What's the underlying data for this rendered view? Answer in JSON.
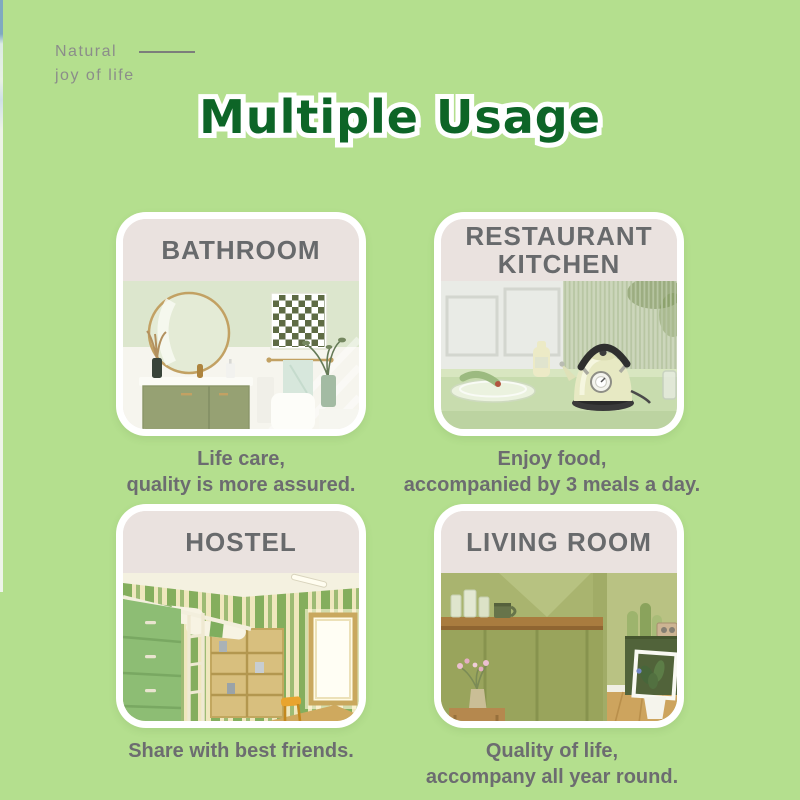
{
  "brand": {
    "line1": "Natural",
    "line2": "joy of life"
  },
  "title": "Multiple Usage",
  "cards": [
    {
      "id": "bathroom",
      "title": "BATHROOM",
      "caption": [
        "Life care,",
        "quality is more assured."
      ]
    },
    {
      "id": "restaurant-kitchen",
      "title": "RESTAURANT KITCHEN",
      "caption": [
        "Enjoy food,",
        "accompanied by 3 meals a day."
      ]
    },
    {
      "id": "hostel",
      "title": "HOSTEL",
      "caption": [
        "Share with best friends."
      ]
    },
    {
      "id": "living-room",
      "title": "LIVING ROOM",
      "caption": [
        "Quality of life,",
        "accompany all year round."
      ]
    }
  ],
  "colors": {
    "background": "#b4df8e",
    "title_green": "#0d6527",
    "title_outline": "#ffffff",
    "card_border": "#ffffff",
    "card_header_bg": "#eae2df",
    "card_header_text": "#686a6c",
    "caption_text": "#6c6c70",
    "brand_text": "#8b8d8a"
  }
}
